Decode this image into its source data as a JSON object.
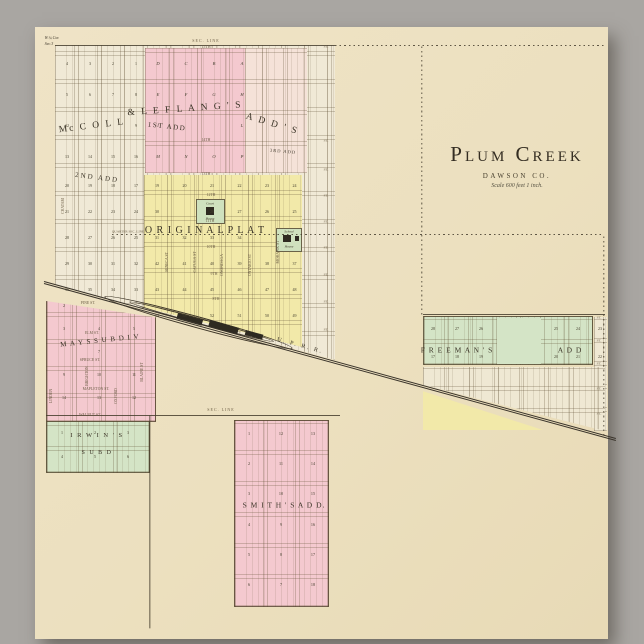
{
  "title": {
    "name": "Plum Creek",
    "county": "DAWSON CO.",
    "scale": "Scale 600 feet 1 inch."
  },
  "colors": {
    "background_gray": "#a9a6a2",
    "paper_cream": "#ece0bf",
    "addition_pink": "#f4c9cf",
    "original_plat_yellow": "#f2e9a9",
    "addition_green": "#d4e4c6",
    "block_white": "#f0e9d6",
    "ink": "#3a3326"
  },
  "zones": [
    {
      "name": "zone-north-plat",
      "x": 55,
      "y": 45,
      "w": 280,
      "h": 315,
      "fill": "#f0e9d6",
      "px": 23,
      "py": 28,
      "clip": "polygon(0 0, 100% 0, 100% 100%, 0 76%)"
    },
    {
      "name": "zone-first-add-east",
      "x": 245,
      "y": 48,
      "w": 62,
      "h": 125,
      "fill": "#f5e2d8",
      "px": 21,
      "py": 31
    },
    {
      "name": "zone-first-add",
      "x": 145,
      "y": 48,
      "w": 100,
      "h": 125,
      "fill": "#f4c9cf",
      "px": 28,
      "py": 31
    },
    {
      "name": "zone-original-plat",
      "x": 144,
      "y": 175,
      "w": 158,
      "h": 172,
      "fill": "#f2e9a9",
      "px": 27,
      "py": 26,
      "clip": "polygon(0 0, 100% 0, 100% 100%, 0 77%)"
    },
    {
      "name": "zone-mays-sub",
      "x": 46,
      "y": 296,
      "w": 110,
      "h": 126,
      "fill": "#f4c9cf",
      "px": 29,
      "py": 27,
      "bd": true,
      "clip": "polygon(0 4%, 100% 17%, 100% 100%, 0 100%)"
    },
    {
      "name": "zone-irwins-sub",
      "x": 46,
      "y": 421,
      "w": 104,
      "h": 52,
      "fill": "#d4e4c6",
      "px": 35,
      "py": 25,
      "bd": true
    },
    {
      "name": "zone-smiths-add",
      "x": 234,
      "y": 420,
      "w": 95,
      "h": 187,
      "fill": "#f4c9cf",
      "px": 32,
      "py": 31,
      "bd": true
    },
    {
      "name": "zone-freemans-add",
      "x": 423,
      "y": 316,
      "w": 170,
      "h": 49,
      "fill": "#d4e4c6",
      "px": 24,
      "py": 24,
      "bd": true
    },
    {
      "name": "zone-freemans-open-block",
      "x": 497,
      "y": 318,
      "w": 44,
      "h": 46,
      "fill": "#d4e4c6"
    },
    {
      "name": "zone-freemans-east-col",
      "x": 594,
      "y": 317,
      "w": 13,
      "h": 114,
      "fill": "#efe8d3",
      "px": 13,
      "py": 23
    },
    {
      "name": "zone-south-blocks",
      "x": 423,
      "y": 367,
      "w": 182,
      "h": 64,
      "fill": "#efe8d3",
      "px": 25,
      "py": 22,
      "clip": "polygon(0 0, 100% 0, 100% 100%, 0 28%)"
    },
    {
      "name": "zone-yellow-wedge",
      "x": 423,
      "y": 387,
      "w": 120,
      "h": 43,
      "fill": "#f2e9a9",
      "clip": "polygon(0 10%, 100% 100%, 0 100%)"
    },
    {
      "name": "zone-court-house-block",
      "x": 196,
      "y": 199,
      "w": 29,
      "h": 25,
      "fill": "#cfe1be",
      "bd": true
    },
    {
      "name": "zone-school-house-block",
      "x": 276,
      "y": 228,
      "w": 26,
      "h": 24,
      "fill": "#cfe1be",
      "bd": true
    },
    {
      "name": "icon-court-house",
      "x": 206,
      "y": 207,
      "w": 8,
      "h": 8,
      "fill": "#2e2a21"
    },
    {
      "name": "icon-school-house",
      "x": 283,
      "y": 235,
      "w": 8,
      "h": 7,
      "fill": "#2e2a21"
    },
    {
      "name": "icon-school-annex",
      "x": 295,
      "y": 236,
      "w": 4,
      "h": 5,
      "fill": "#2e2a21"
    },
    {
      "name": "rr-siding-outer",
      "x": 106,
      "y": 291,
      "w": 195,
      "h": 12,
      "fill": "transparent",
      "rot": 15.3,
      "bw": 0.8,
      "bc": "#3d3527",
      "br": "50%"
    },
    {
      "name": "rr-siding-inner",
      "x": 130,
      "y": 299,
      "w": 150,
      "h": 6,
      "fill": "transparent",
      "rot": 15.3,
      "bw": 0.7,
      "bc": "#3d3527",
      "br": "50%"
    },
    {
      "name": "rr-depot-1",
      "x": 178,
      "y": 313,
      "w": 26,
      "h": 6,
      "fill": "#2e2a21",
      "rot": 15.3
    },
    {
      "name": "rr-depot-2",
      "x": 210,
      "y": 320,
      "w": 30,
      "h": 7,
      "fill": "#2e2a21",
      "rot": 15.3
    },
    {
      "name": "rr-depot-3",
      "x": 246,
      "y": 330,
      "w": 18,
      "h": 5,
      "fill": "#2e2a21",
      "rot": 15.3
    }
  ],
  "lines": [
    {
      "name": "rr-track-line-1",
      "x1": 44,
      "y1": 281,
      "x2": 616,
      "y2": 438,
      "w": 0.9,
      "c": "#3a342b"
    },
    {
      "name": "rr-track-line-2",
      "x1": 44,
      "y1": 283.5,
      "x2": 616,
      "y2": 440.5,
      "w": 0.9,
      "c": "#3a342b"
    },
    {
      "name": "sec-line-top",
      "x1": 55,
      "y1": 45,
      "x2": 335,
      "y2": 45,
      "w": 0.8
    },
    {
      "name": "sec-line-top-east",
      "x1": 335,
      "y1": 45.5,
      "x2": 605,
      "y2": 45.5,
      "w": 0.7,
      "dash": true
    },
    {
      "name": "quarter-sec-line",
      "x1": 112,
      "y1": 234.5,
      "x2": 604,
      "y2": 234.5,
      "w": 0.6,
      "dash": true
    },
    {
      "name": "section-line-vertical",
      "x1": 422,
      "y1": 46,
      "x2": 422,
      "y2": 315,
      "w": 0.6,
      "dash": true
    },
    {
      "name": "sec-line-bottom",
      "x1": 46,
      "y1": 415,
      "x2": 340,
      "y2": 415,
      "w": 0.8
    },
    {
      "name": "meridian-line-south",
      "x1": 150,
      "y1": 415,
      "x2": 150,
      "y2": 628,
      "w": 0.7
    },
    {
      "name": "east-boundary-line",
      "x1": 604,
      "y1": 236,
      "x2": 604,
      "y2": 436,
      "w": 0.6,
      "dash": true
    },
    {
      "name": "freemans-north-line",
      "x1": 423,
      "y1": 314.5,
      "x2": 605,
      "y2": 314.5,
      "w": 0.7
    }
  ],
  "labels": [
    {
      "name": "label-sec-line-top",
      "text": "SEC. LINE",
      "x": 206,
      "y": 40.5,
      "s": 4,
      "ls": 1,
      "c": "#6b5d45"
    },
    {
      "name": "label-15th-st",
      "text": "15TH",
      "x": 206,
      "y": 47,
      "s": 4,
      "c": "#6b5d45"
    },
    {
      "name": "label-corner-note-1",
      "text": "W.¼ Cor.",
      "x": 52,
      "y": 38,
      "s": 4,
      "it": true
    },
    {
      "name": "label-corner-note-2",
      "text": "Sec.3",
      "x": 49,
      "y": 44,
      "s": 4,
      "it": true
    },
    {
      "name": "label-mccoll",
      "text": "Mc C O L L",
      "x": 92,
      "y": 127,
      "s": 9.5,
      "rot": -7,
      "ls": 2
    },
    {
      "name": "label-leflang",
      "text": "&  L E F L A N G ' S",
      "x": 185,
      "y": 110,
      "s": 9.5,
      "rot": -4,
      "ls": 2
    },
    {
      "name": "label-adds",
      "text": "A D D ' S",
      "x": 272,
      "y": 125,
      "s": 9.5,
      "rot": 17,
      "ls": 2
    },
    {
      "name": "label-first-add",
      "text": "1ST ADD",
      "x": 167,
      "y": 127,
      "s": 7,
      "rot": 6,
      "ls": 1.5
    },
    {
      "name": "label-second-add",
      "text": "2ND ADD",
      "x": 97,
      "y": 178,
      "s": 7,
      "rot": 7,
      "ls": 2
    },
    {
      "name": "label-third-add",
      "text": "3RD ADD",
      "x": 283,
      "y": 152,
      "s": 4.5,
      "rot": 5,
      "ls": 1
    },
    {
      "name": "label-original-plat",
      "text": "O R I G I N A L   P L A T",
      "x": 205,
      "y": 231,
      "s": 10,
      "ls": 1
    },
    {
      "name": "label-mays-sub",
      "text": "M A Y S   S U B   D I V",
      "x": 100,
      "y": 341,
      "s": 7,
      "rot": -6,
      "ls": 1
    },
    {
      "name": "label-irwins-1",
      "text": "I R W I N ' S",
      "x": 97,
      "y": 436,
      "s": 6.5,
      "ls": 1.5
    },
    {
      "name": "label-irwins-2",
      "text": "S U B   D",
      "x": 97,
      "y": 453,
      "s": 6,
      "ls": 1.5
    },
    {
      "name": "label-smiths-add",
      "text": "S M I T H ' S   A D D.",
      "x": 284,
      "y": 505,
      "s": 7.5,
      "ls": 1
    },
    {
      "name": "label-freemans-1",
      "text": "F R E E M A N ' S",
      "x": 457,
      "y": 350,
      "s": 7.5,
      "ls": 1
    },
    {
      "name": "label-freemans-2",
      "text": "A D D",
      "x": 570,
      "y": 350,
      "s": 7.5,
      "ls": 1
    },
    {
      "name": "label-uprr",
      "text": "U. P. R. R.",
      "x": 300,
      "y": 346,
      "s": 6,
      "rot": 15.3,
      "ls": 2
    },
    {
      "name": "label-quarter-sec-line",
      "text": "QUARTER SEC. LINE",
      "x": 128,
      "y": 231.5,
      "s": 3.4,
      "c": "#6b5d45"
    },
    {
      "name": "label-sec-line-bottom",
      "text": "SEC. LINE",
      "x": 221,
      "y": 410,
      "s": 4,
      "ls": 1,
      "c": "#6b5d45"
    },
    {
      "name": "label-court-house-1",
      "text": "Court",
      "x": 210,
      "y": 204,
      "s": 3.4,
      "it": true
    },
    {
      "name": "label-court-house-2",
      "text": "House",
      "x": 210,
      "y": 219,
      "s": 3.4,
      "it": true
    },
    {
      "name": "label-school-house-1",
      "text": "School",
      "x": 289,
      "y": 232,
      "s": 3.4,
      "it": true
    },
    {
      "name": "label-school-house-2",
      "text": "House",
      "x": 289,
      "y": 247,
      "s": 3.4,
      "it": true
    },
    {
      "name": "label-seneca-st",
      "text": "SENECA  ST",
      "x": 168,
      "y": 262,
      "s": 3.8,
      "rot": -90,
      "c": "#6b5d45"
    },
    {
      "name": "label-cayuga-st",
      "text": "CAYUGA  ST",
      "x": 196,
      "y": 262,
      "s": 3.8,
      "rot": -90,
      "c": "#6b5d45"
    },
    {
      "name": "label-onondaga-st",
      "text": "ONONDAGA",
      "x": 223,
      "y": 265,
      "s": 3.8,
      "rot": -90,
      "c": "#6b5d45"
    },
    {
      "name": "label-ontario-st",
      "text": "ONTARIO  ST",
      "x": 251,
      "y": 265,
      "s": 3.8,
      "rot": -90,
      "c": "#6b5d45"
    },
    {
      "name": "label-mohawk-st",
      "text": "MOHAWK  ST",
      "x": 279,
      "y": 252,
      "s": 3.8,
      "rot": -90,
      "c": "#6b5d45"
    },
    {
      "name": "label-chatam-st",
      "text": "CHATAM",
      "x": 64,
      "y": 206,
      "s": 3.8,
      "rot": -90,
      "c": "#6b5d45"
    },
    {
      "name": "label-14th-st",
      "text": "14TH",
      "x": 206,
      "y": 141,
      "s": 3.8,
      "c": "#6b5d45"
    },
    {
      "name": "label-13th-st",
      "text": "13TH",
      "x": 206,
      "y": 175,
      "s": 3.8,
      "c": "#6b5d45"
    },
    {
      "name": "label-12th-st",
      "text": "12TH",
      "x": 211,
      "y": 196,
      "s": 3.8,
      "c": "#6b5d45"
    },
    {
      "name": "label-11th-st",
      "text": "11TH",
      "x": 210,
      "y": 222,
      "s": 3.8,
      "c": "#6b5d45"
    },
    {
      "name": "label-10th-st",
      "text": "10TH",
      "x": 211,
      "y": 248,
      "s": 3.8,
      "c": "#6b5d45"
    },
    {
      "name": "label-9th-st",
      "text": "9TH",
      "x": 214,
      "y": 275,
      "s": 3.8,
      "c": "#6b5d45"
    },
    {
      "name": "label-8th-st",
      "text": "8TH",
      "x": 216,
      "y": 300,
      "s": 3.8,
      "c": "#6b5d45"
    },
    {
      "name": "label-pine-st",
      "text": "PINE  ST.",
      "x": 88,
      "y": 304,
      "s": 3.8,
      "c": "#6b5d45"
    },
    {
      "name": "label-elm-st",
      "text": "ELM  ST.",
      "x": 92,
      "y": 334,
      "s": 3.8,
      "c": "#6b5d45"
    },
    {
      "name": "label-spruce-st",
      "text": "SPRUCE  ST.",
      "x": 90,
      "y": 361,
      "s": 3.8,
      "c": "#6b5d45"
    },
    {
      "name": "label-mapleton-st",
      "text": "MAPLETON  ST.",
      "x": 96,
      "y": 390,
      "s": 3.8,
      "c": "#6b5d45"
    },
    {
      "name": "label-walnut-st",
      "text": "WALNUT  ST.",
      "x": 90,
      "y": 416,
      "s": 3.8,
      "c": "#6b5d45"
    },
    {
      "name": "label-brighton-st",
      "text": "BRIGHTON",
      "x": 88,
      "y": 376,
      "s": 3.8,
      "rot": -90,
      "c": "#6b5d45"
    },
    {
      "name": "label-oxford-st",
      "text": "OXFORD",
      "x": 117,
      "y": 396,
      "s": 3.8,
      "rot": -90,
      "c": "#6b5d45"
    },
    {
      "name": "label-blaine-st",
      "text": "BLAINE  ST",
      "x": 143,
      "y": 372,
      "s": 3.8,
      "rot": -90,
      "c": "#6b5d45"
    },
    {
      "name": "label-linden-st",
      "text": "LINDEN",
      "x": 52,
      "y": 396,
      "s": 3.8,
      "rot": -90,
      "c": "#6b5d45"
    }
  ],
  "st_marks": [
    {
      "name": "street-end-marks-west",
      "text": "ST.",
      "x": 326,
      "ys": [
        47,
        141,
        170,
        196,
        222,
        248,
        275,
        302,
        330
      ]
    },
    {
      "name": "street-end-marks-east",
      "text": "ST.",
      "x": 599,
      "ys": [
        318,
        341,
        364,
        389,
        414
      ]
    }
  ],
  "number_grids": [
    {
      "name": "blocks-mccoll",
      "x0": 67,
      "y0": 64,
      "dx": 23,
      "dy": 31,
      "s": 4,
      "rows": [
        [
          "4",
          "3",
          "2",
          "1"
        ],
        [
          "5",
          "6",
          "7",
          "8"
        ],
        [
          "12",
          "",
          "",
          "9"
        ],
        [
          "13",
          "14",
          "15",
          "16"
        ]
      ]
    },
    {
      "name": "blocks-second-add",
      "x0": 67,
      "y0": 186,
      "dx": 23,
      "dy": 26,
      "s": 4,
      "rows": [
        [
          "20",
          "19",
          "18",
          "17"
        ],
        [
          "21",
          "22",
          "23",
          "24"
        ],
        [
          "28",
          "27",
          "26",
          "25"
        ],
        [
          "29",
          "30",
          "31",
          "32"
        ],
        [
          "36",
          "35",
          "34",
          "33"
        ]
      ]
    },
    {
      "name": "blocks-first-add",
      "x0": 158,
      "y0": 64,
      "dx": 28,
      "dy": 31,
      "s": 4.5,
      "it": true,
      "rows": [
        [
          "D",
          "C",
          "B",
          "A"
        ],
        [
          "E",
          "F",
          "G",
          "H"
        ],
        [
          "I",
          "",
          "",
          "L"
        ],
        [
          "M",
          "N",
          "O",
          "P"
        ]
      ]
    },
    {
      "name": "blocks-original-plat",
      "x0": 157,
      "y0": 186,
      "dx": 27.5,
      "dy": 26,
      "s": 4,
      "rows": [
        [
          "19",
          "20",
          "21",
          "22",
          "23",
          "24"
        ],
        [
          "30",
          "",
          "28",
          "27",
          "26",
          "25"
        ],
        [
          "31",
          "32",
          "33",
          "34",
          "",
          ""
        ],
        [
          "42",
          "41",
          "40",
          "39",
          "38",
          "37"
        ],
        [
          "43",
          "44",
          "45",
          "46",
          "47",
          "48"
        ],
        [
          "54",
          "53",
          "52",
          "51",
          "50",
          "49"
        ]
      ]
    },
    {
      "name": "blocks-mays",
      "x0": 64,
      "y0": 306,
      "dx": 35,
      "dy": 23,
      "s": 4,
      "rows": [
        [
          "2",
          "",
          ""
        ],
        [
          "3",
          "4",
          "5"
        ],
        [
          "",
          "7",
          ""
        ],
        [
          "9",
          "10",
          "11"
        ],
        [
          "14",
          "13",
          "12"
        ]
      ]
    },
    {
      "name": "blocks-irwins",
      "x0": 62,
      "y0": 433,
      "dx": 33,
      "dy": 24,
      "s": 4,
      "rows": [
        [
          "1",
          "2",
          "3"
        ],
        [
          "4",
          "5",
          "6"
        ]
      ]
    },
    {
      "name": "blocks-smiths",
      "x0": 249,
      "y0": 434,
      "dx": 32,
      "dy": 30.2,
      "s": 4.2,
      "rows": [
        [
          "1",
          "12",
          "13"
        ],
        [
          "2",
          "11",
          "14"
        ],
        [
          "3",
          "10",
          "15"
        ],
        [
          "4",
          "9",
          "16"
        ],
        [
          "5",
          "8",
          "17"
        ],
        [
          "6",
          "7",
          "18"
        ]
      ]
    },
    {
      "name": "blocks-freemans-west",
      "x0": 433,
      "y0": 329,
      "dx": 24,
      "dy": 28,
      "s": 4,
      "rows": [
        [
          "28",
          "27",
          "26"
        ],
        [
          "17",
          "18",
          "19"
        ]
      ]
    },
    {
      "name": "blocks-freemans-east",
      "x0": 556,
      "y0": 329,
      "dx": 22,
      "dy": 28,
      "s": 4,
      "rows": [
        [
          "25",
          "24",
          "23"
        ],
        [
          "20",
          "21",
          "22"
        ]
      ]
    }
  ]
}
